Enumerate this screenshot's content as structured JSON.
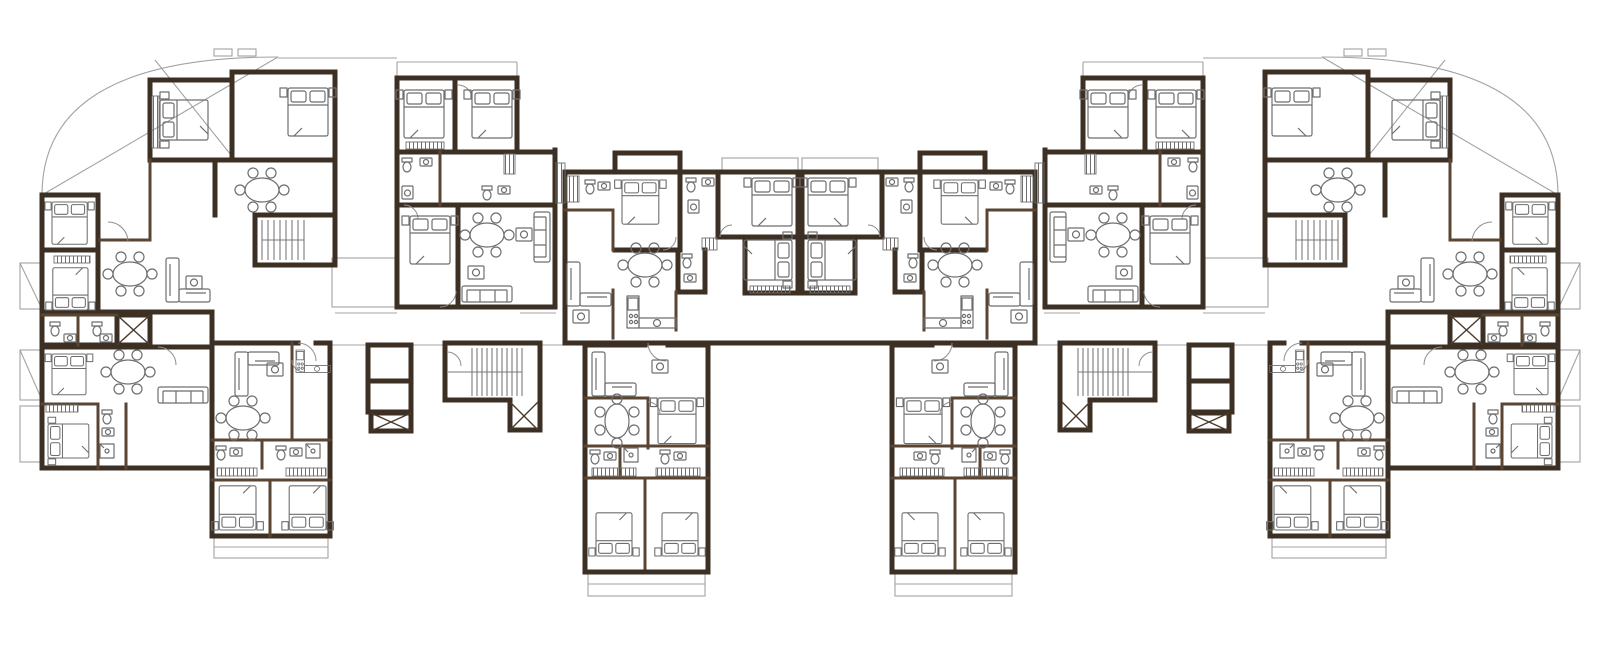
{
  "document": {
    "kind": "architectural floor plan",
    "description": "Symmetric residential typical floor plan, two mirrored wings, no text labels visible",
    "visible_text": []
  },
  "colors": {
    "background": "#ffffff",
    "wall": "#3c2f23",
    "wall_medium": "#5a4533",
    "furniture": "#6e6e6e",
    "thin_line": "#a3a3a3",
    "door": "#8f8f8f",
    "stairs": "#7a7a7a",
    "hatch": "#6f6f6f",
    "lift_cross": "#4a3b2d"
  },
  "plan": {
    "symmetry": "mirrored about vertical center axis",
    "wings": [
      "left-wing",
      "right-wing (mirror of left)"
    ],
    "blocks_per_wing": [
      {
        "name": "corner-apartment-upper",
        "features": {
          "double_beds": 4,
          "dining_tables": 2,
          "l_sofa": 1,
          "staircase": 1,
          "elevator": 1,
          "bath_clusters": 1,
          "curved_terrace": 1
        }
      },
      {
        "name": "corner-apartment-lower",
        "features": {
          "double_beds": 2,
          "dining_tables": 1,
          "sofa": 1,
          "bath_clusters": 1,
          "balconies": 2
        }
      },
      {
        "name": "top-middle-apartment",
        "features": {
          "double_beds": 3,
          "dining_tables": 1,
          "sofas": 2,
          "bath_clusters": 2,
          "balconies": 2
        }
      },
      {
        "name": "centre-apartment",
        "features": {
          "double_beds": 3,
          "dining_tables": 1,
          "l_sofa": 1,
          "kitchen": 1,
          "bath_clusters": 2,
          "balcony": 1
        }
      },
      {
        "name": "inner-lower-tower",
        "features": {
          "double_beds": 3,
          "dining_tables": 1,
          "l_sofa": 1,
          "bath_clusters": 2,
          "balcony": 1
        }
      },
      {
        "name": "outer-lower-tower",
        "features": {
          "double_beds": 2,
          "dining_tables": 1,
          "l_sofa": 1,
          "kitchenette": 1,
          "bath_clusters": 2,
          "balcony": 1
        }
      },
      {
        "name": "service-core-lifts",
        "features": {
          "shafts": 2,
          "elevator": 1
        }
      },
      {
        "name": "service-core-stair",
        "features": {
          "staircase": 1,
          "elevator": 1
        }
      }
    ],
    "glyph_legend": [
      "double-bed-with-pillows",
      "dining-table-6-chairs",
      "l-shaped-sofa",
      "straight-sofa",
      "coffee-table",
      "wardrobe-hatched",
      "toilet",
      "wash-basin",
      "shower",
      "washing-machine",
      "kitchen-counter",
      "staircase-treads",
      "elevator-x-box",
      "balcony-railing",
      "curved-terrace-edge",
      "door-swing-arc"
    ],
    "approx_glyph_counts_total": {
      "double_beds": 34,
      "dining_tables": 14,
      "l_sofas": 8,
      "straight_sofas": 6,
      "wardrobes": 26,
      "staircases": 4,
      "elevators": 6,
      "bath_fixture_clusters": 16,
      "balconies": 14,
      "kitchens": 4
    }
  }
}
